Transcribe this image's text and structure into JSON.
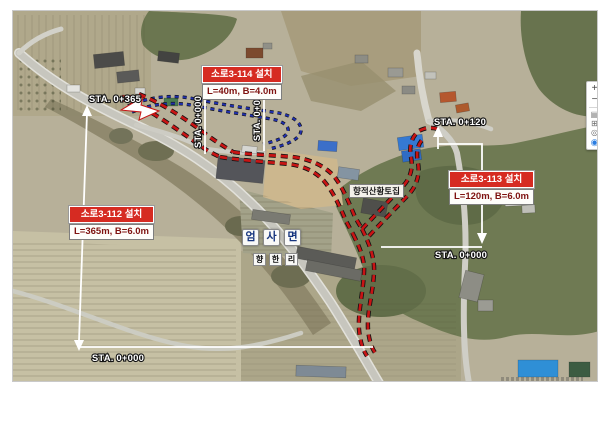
{
  "map": {
    "annotations": {
      "route112": {
        "title": "소로3-112 설치",
        "spec": "L=365m, B=6.0m",
        "sta_top": "STA. 0+365",
        "sta_bottom": "STA. 0+000"
      },
      "route113": {
        "title": "소로3-113 설치",
        "spec": "L=120m, B=6.0m",
        "sta_top": "STA. 0+120",
        "sta_bottom": "STA. 0+000"
      },
      "route114": {
        "title": "소로3-114 설치",
        "spec": "L=40m, B=4.0m",
        "sta_left": "STA. 0+000",
        "sta_right": "STA. 0+040"
      }
    },
    "region_labels": {
      "town": {
        "text": "엄사면",
        "chars": [
          "엄",
          "사",
          "면"
        ]
      },
      "village": {
        "text": "향한리",
        "chars": [
          "향",
          "한",
          "리"
        ]
      },
      "poi": "향적산황토집"
    },
    "controls": {
      "zoom_in": "+",
      "zoom_out": "−",
      "layers_icon": "▤",
      "split_icon": "⊞",
      "target_icon": "◎",
      "pin_icon": "◉"
    },
    "colors": {
      "route_red": "#c81414",
      "route_blue": "#2130ad",
      "callout_red": "#d62b22",
      "dimension_white": "#ffffff",
      "town_text": "#16347e"
    }
  }
}
